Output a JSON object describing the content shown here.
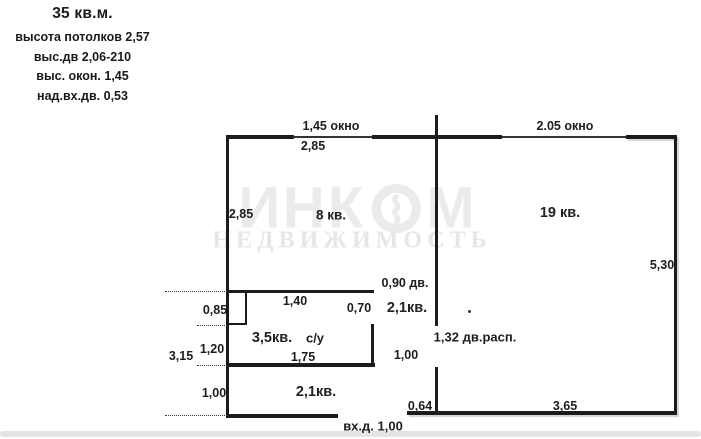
{
  "legend": {
    "area": "35 кв.м.",
    "lines": [
      "высота потолков 2,57",
      "выс.дв 2,06-210",
      "выс. окон. 1,45",
      "над.вх.дв. 0,53"
    ]
  },
  "watermark": {
    "brand": "ИНКОМ",
    "brand_left": "ИНК",
    "brand_right": "М",
    "subtitle": "НЕДВИЖИМОСТЬ"
  },
  "rooms": {
    "room8": "8 кв.",
    "room19": "19 кв.",
    "hall": "2,1кв.",
    "bathroom": "3,5кв.",
    "wc": "с/у",
    "corridor": "2,1кв."
  },
  "dimensions": {
    "window_left": "1,45 окно",
    "room8_width": "2,85",
    "window_right": "2.05 окно",
    "room8_height": "2,85",
    "room19_height": "5,30",
    "door_hall": "0,90 дв.",
    "bath_top": "1,40",
    "bath_door": "0,70",
    "shaft_height": "0,85",
    "bath_left": "1,20",
    "left_total": "3,15",
    "bath_bottom": "1,75",
    "hall_height": "1,00",
    "door_partition": "1,32 дв.расп.",
    "corridor_left": "1,00",
    "corridor_bottom_right": "0,64",
    "room19_bottom": "3,65",
    "entrance_door": "вх.д. 1,00"
  },
  "colors": {
    "wall": "#1c1c1c",
    "ink": "#1a1a1a",
    "watermark_primary": "#edeaea",
    "watermark_secondary": "#eae5e5",
    "paper": "#ffffff",
    "scan_shadow": "#d8d5d2"
  }
}
